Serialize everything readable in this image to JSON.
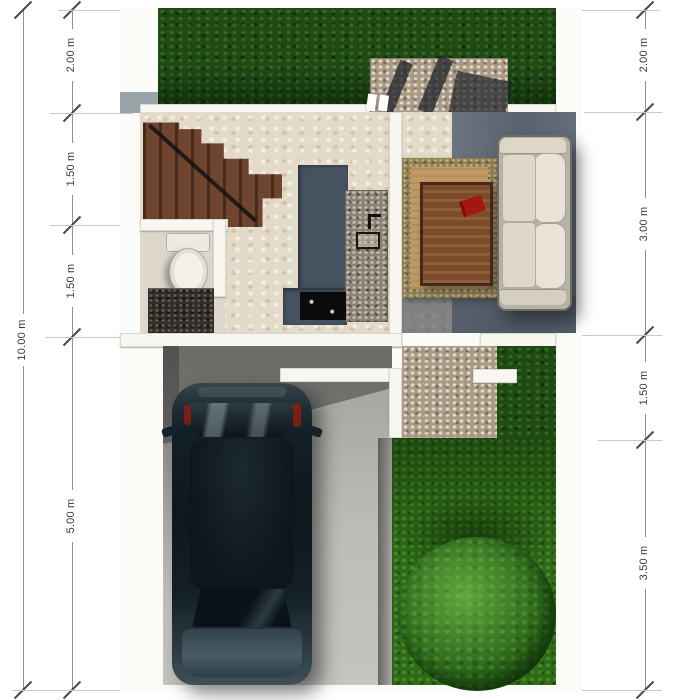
{
  "page": {
    "type": "house-plot-floor-plan-render",
    "background": "#ffffff"
  },
  "dimensions": {
    "unit": "m",
    "left_overall": {
      "label": "10.00 m"
    },
    "left_segments": [
      {
        "label": "2.00 m"
      },
      {
        "label": "1.50 m"
      },
      {
        "label": "1.50 m"
      },
      {
        "label": "5.00 m"
      }
    ],
    "right_segments": [
      {
        "label": "2.00 m"
      },
      {
        "label": "3.00 m"
      },
      {
        "label": "1.50 m"
      },
      {
        "label": "3.50 m"
      }
    ]
  },
  "scene": {
    "objects": [
      "front-lawn",
      "entry-gravel-patio",
      "staircase",
      "bathroom-toilet",
      "bathroom-vanity",
      "kitchen-counter",
      "cooktop",
      "kitchen-sink",
      "tv-panel",
      "area-rug",
      "coffee-table",
      "red-book",
      "sofa",
      "carport-driveway",
      "car",
      "garden-gravel-path",
      "garden-lawn",
      "round-tree"
    ],
    "colors": {
      "lawn_dark": "#1f4a14",
      "lawn_bright": "#2e6b17",
      "gravel": "#a89a85",
      "interior_floor": "#e3dac8",
      "stairs_wood": "#70452f",
      "kitchen_counter": "#46525f",
      "rug": "#c29b63",
      "sofa": "#e9e3d5",
      "car_body": "#132026",
      "concrete": "#b5b3ad",
      "tree": "#2f6c1c",
      "accent_red": "#a31710"
    }
  }
}
